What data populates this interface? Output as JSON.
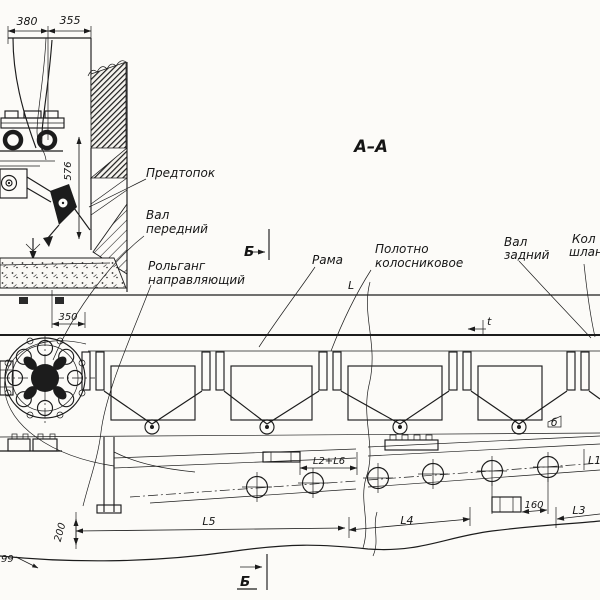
{
  "drawing": {
    "section_title": "А–А",
    "labels": {
      "predtopok": "Предтопок",
      "val_front_l1": "Вал",
      "val_front_l2": "передний",
      "rolgang_l1": "Рольганг",
      "rolgang_l2": "направляющий",
      "rama": "Рама",
      "polotno_l1": "Полотно",
      "polotno_l2": "колосниковое",
      "val_rear_l1": "Вал",
      "val_rear_l2": "задний",
      "edge_cut_l1": "Кол",
      "edge_cut_l2": "шлан",
      "flag_small": "б"
    },
    "markers": {
      "section_top": "Б",
      "section_bottom": "Б"
    },
    "dims": {
      "d380": "380",
      "d355": "355",
      "d576": "576",
      "d350": "350",
      "d200": "200",
      "d99": "99",
      "d160": "160",
      "len_L": "L",
      "pitch_t": "t",
      "L1": "L1",
      "L2L6": "L2+L6",
      "L3": "L3",
      "L4": "L4",
      "L5": "L5"
    },
    "colors": {
      "ink": "#1c1c1c",
      "paper": "#fcfbf8"
    }
  }
}
